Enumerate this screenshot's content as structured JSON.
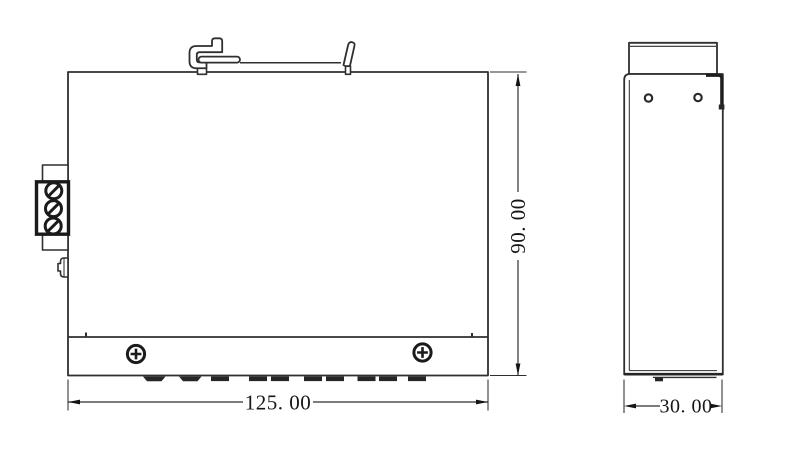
{
  "drawing": {
    "kind": "technical-dimension-drawing",
    "background": "#ffffff",
    "line_color": "#2f2f2f",
    "dark_fill_color": "#262626",
    "text_color": "#161616",
    "views": {
      "front": {
        "name": "front-view",
        "width_dim": {
          "label": "125. 00"
        },
        "height_dim": {
          "label": "90. 00"
        },
        "terminal_block": {
          "screw_count": 3
        },
        "panel_screw_count": 2,
        "bottom_tab_count": 8,
        "bottom_foot_count": 2
      },
      "side": {
        "name": "side-view",
        "depth_dim": {
          "label": "30. 00"
        },
        "hole_count": 2
      }
    }
  }
}
